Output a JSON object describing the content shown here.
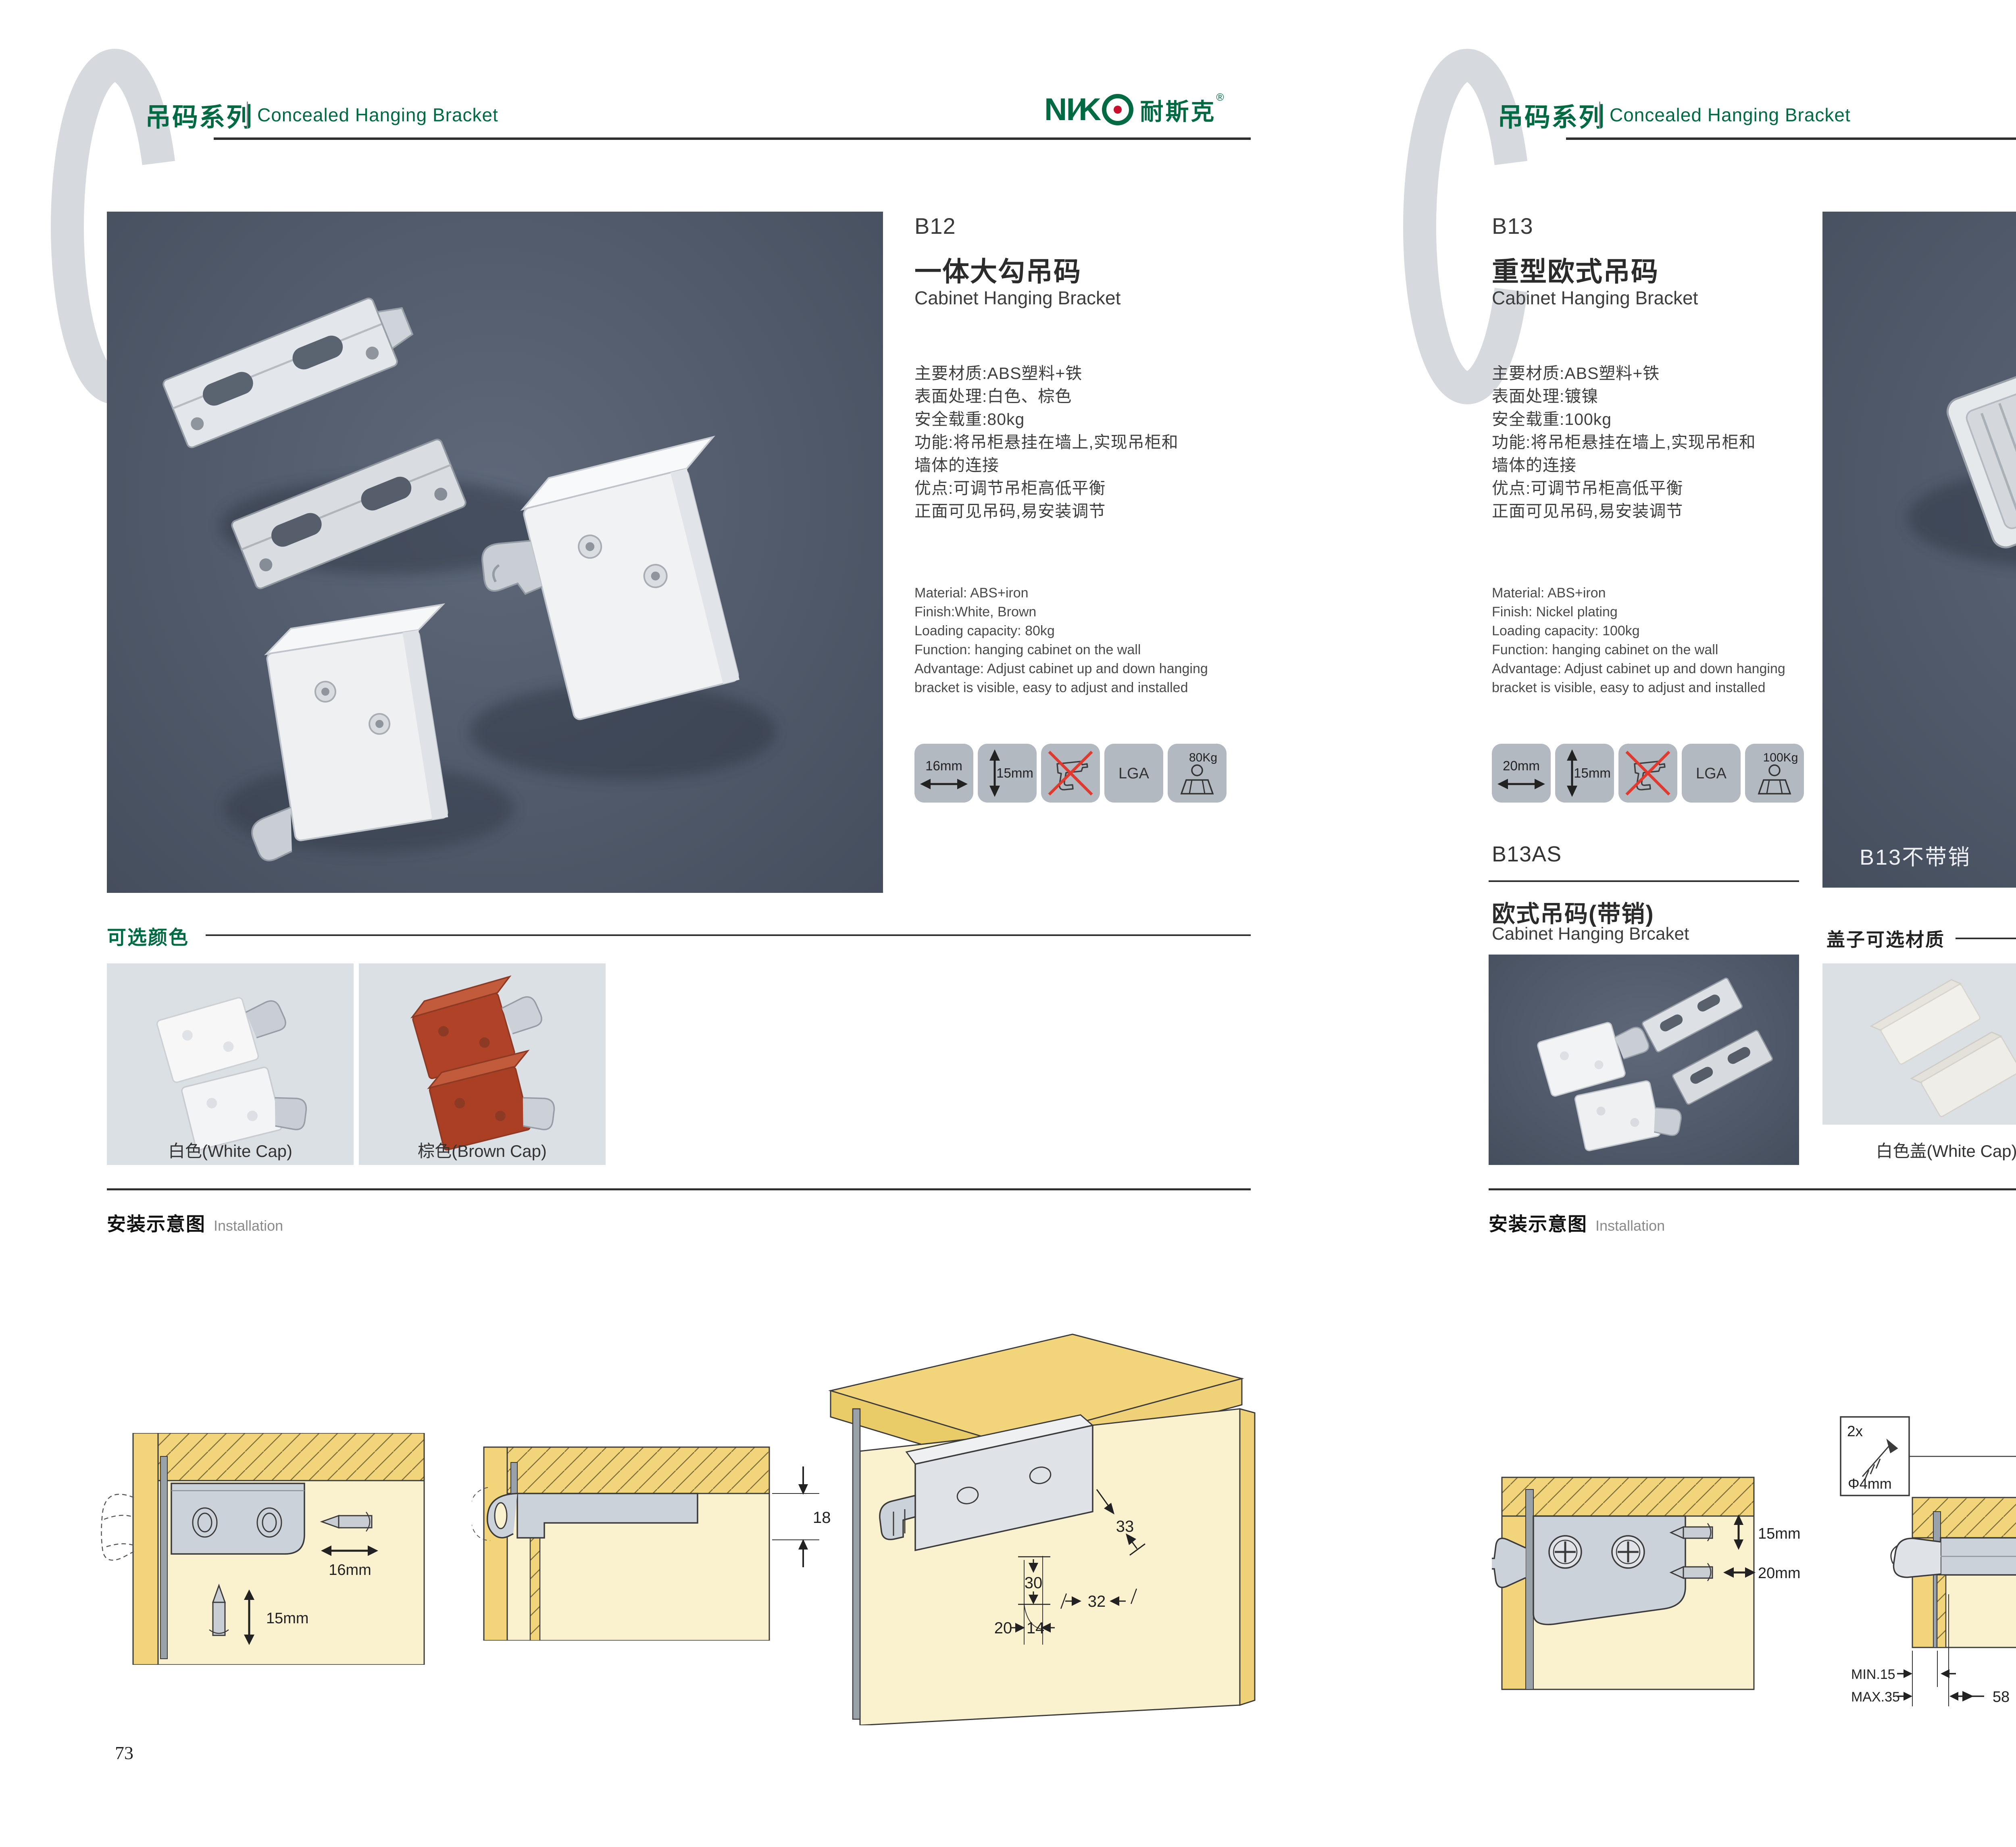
{
  "header": {
    "series_cn": "吊码系列",
    "series_en": "Concealed Hanging Bracket",
    "brand": {
      "n1": "NI",
      "slash": "∕",
      "k": "K",
      "cn": "耐斯克",
      "reg": "®"
    }
  },
  "left": {
    "page_no": "73",
    "code": "B12",
    "name_cn": "一体大勾吊码",
    "name_en": "Cabinet Hanging Bracket",
    "specs_cn": [
      "主要材质:ABS塑料+铁",
      "表面处理:白色、棕色",
      "安全载重:80kg",
      "功能:将吊柜悬挂在墙上,实现吊柜和",
      "墙体的连接",
      "优点:可调节吊柜高低平衡",
      "正面可见吊码,易安装调节"
    ],
    "specs_en": [
      "Material: ABS+iron",
      "Finish:White, Brown",
      "Loading capacity: 80kg",
      "Function: hanging cabinet on the wall",
      "Advantage: Adjust cabinet up and down hanging",
      "bracket is visible, easy to adjust and installed"
    ],
    "icons": {
      "w": "16mm",
      "h": "15mm",
      "cert": "LGA",
      "load": "80Kg"
    },
    "colors_title": "可选颜色",
    "swatch1_caption": "白色(White Cap)",
    "swatch2_caption": "棕色(Brown Cap)",
    "install_cn": "安装示意图",
    "install_en": "Installation",
    "diag1": {
      "w": "16mm",
      "h": "15mm"
    },
    "diag2": {
      "depth": "18"
    },
    "diag3": {
      "a": "33",
      "b": "30",
      "c": "32",
      "d": "20",
      "e": "14"
    }
  },
  "right": {
    "page_no": "74",
    "code": "B13",
    "name_cn": "重型欧式吊码",
    "name_en": "Cabinet Hanging Bracket",
    "specs_cn": [
      "主要材质:ABS塑料+铁",
      "表面处理:镀镍",
      "安全载重:100kg",
      "功能:将吊柜悬挂在墙上,实现吊柜和",
      "墙体的连接",
      "优点:可调节吊柜高低平衡",
      "正面可见吊码,易安装调节"
    ],
    "specs_en": [
      "Material: ABS+iron",
      "Finish: Nickel plating",
      "Loading capacity: 100kg",
      "Function: hanging cabinet on the wall",
      "Advantage: Adjust cabinet up and down hanging",
      "bracket is visible, easy to adjust and installed"
    ],
    "icons": {
      "w": "20mm",
      "h": "15mm",
      "cert": "LGA",
      "load": "100Kg"
    },
    "photo_label": "B13不带销",
    "sub_code": "B13AS",
    "sub_name_cn": "欧式吊码(带销)",
    "sub_name_en": "Cabinet Hanging Brcaket",
    "caps_title": "盖子可选材质",
    "cap1_caption": "白色盖(White Cap)",
    "cap2_caption": "灰色盖(Gray Cap)",
    "install_cn": "安装示意图",
    "install_en": "Installation",
    "diag1": {
      "h": "15mm",
      "w": "20mm"
    },
    "diag2": {
      "qty": "2x",
      "dia": "Φ4mm",
      "depth": "18",
      "min": "MIN.15",
      "max": "MAX.35",
      "span": "58"
    },
    "diag3": {
      "a": "16",
      "b": "40",
      "r": "RMAX4",
      "c": "19",
      "d": "18",
      "e": "32"
    }
  },
  "colors": {
    "green": "#006B43",
    "ink": "#2e2e2e",
    "photo_bg": "#4d5565",
    "tile_bg": "#b2b9c1",
    "swatch_bg": "#dbe0e4",
    "wood": "#F2D47A",
    "cream": "#FAF1CE",
    "no_drill_red": "#E0392E"
  }
}
